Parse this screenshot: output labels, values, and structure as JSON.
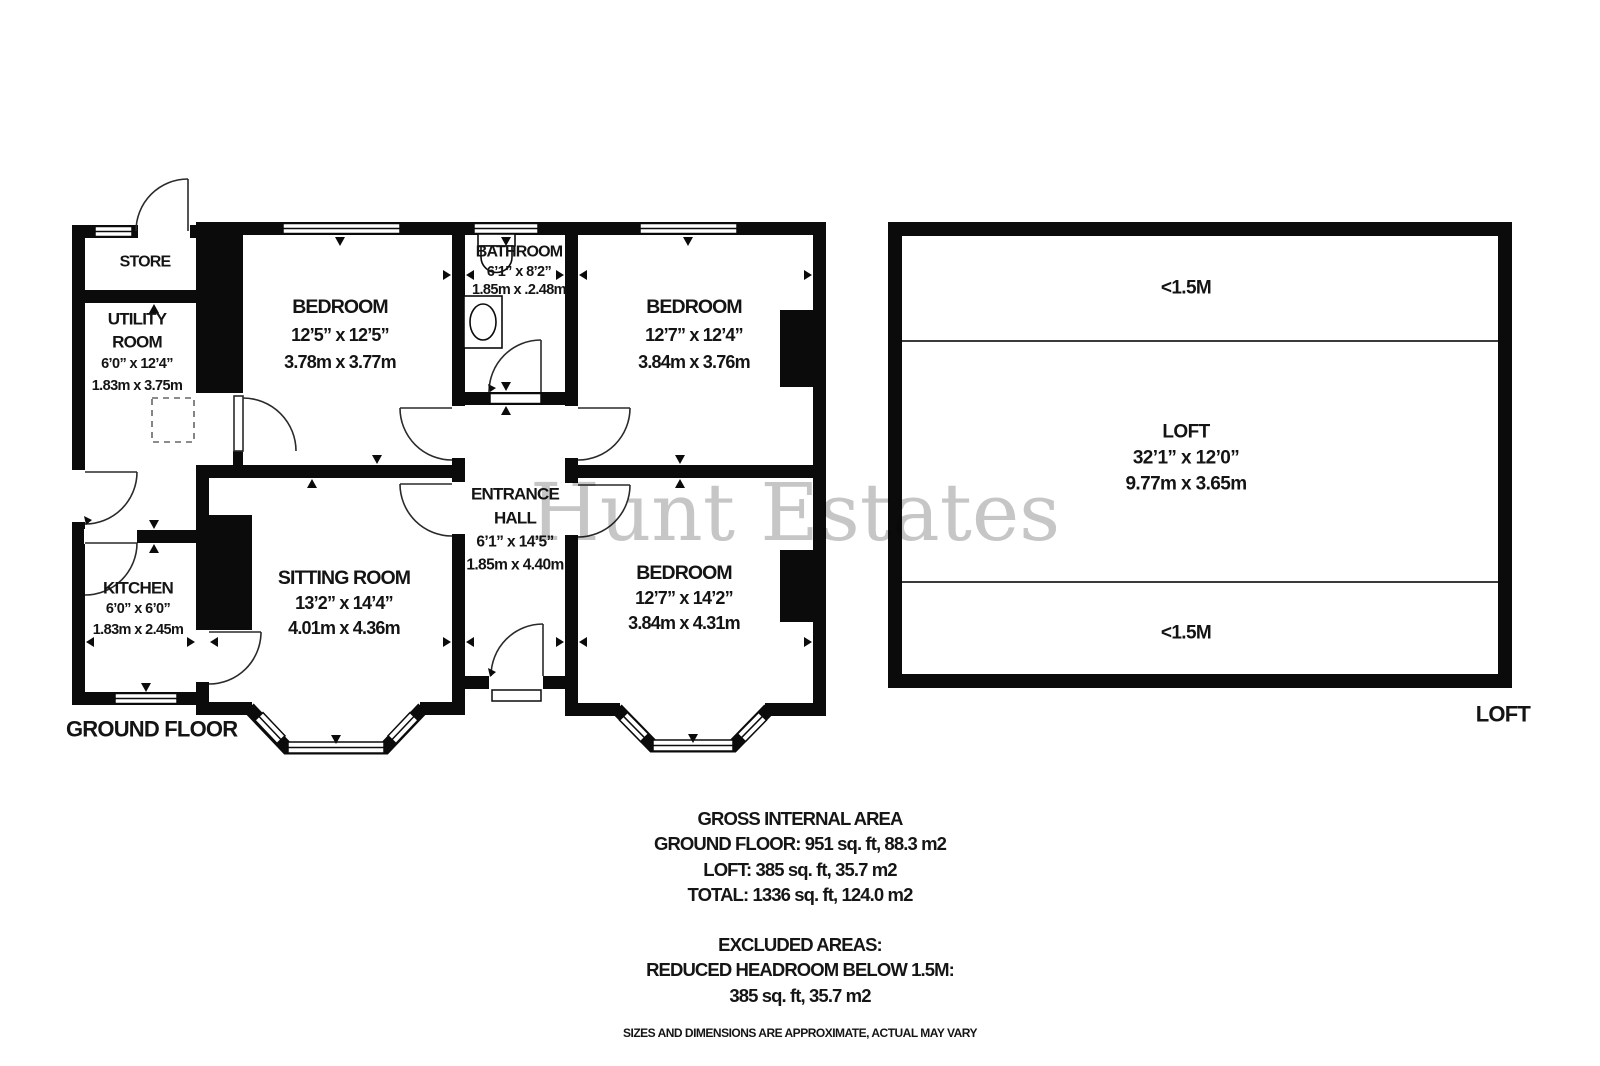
{
  "watermark": "Hunt Estates",
  "plan": {
    "ground_floor": {
      "label": "GROUND FLOOR",
      "rooms": {
        "store": {
          "name": "STORE"
        },
        "utility": {
          "line1": "UTILITY",
          "line2": "ROOM",
          "imperial": "6’0” x 12’4”",
          "metric": "1.83m x 3.75m"
        },
        "bedroom_front_left": {
          "name": "BEDROOM",
          "imperial": "12’5” x 12’5”",
          "metric": "3.78m x 3.77m"
        },
        "bathroom": {
          "name": "BATHROOM",
          "imperial": "6’1” x 8’2”",
          "metric": "1.85m x .2.48m"
        },
        "bedroom_front_right": {
          "name": "BEDROOM",
          "imperial": "12’7” x 12’4”",
          "metric": "3.84m x 3.76m"
        },
        "entrance_hall": {
          "line1": "ENTRANCE",
          "line2": "HALL",
          "imperial": "6’1” x 14’5”",
          "metric": "1.85m x 4.40m"
        },
        "sitting_room": {
          "name": "SITTING ROOM",
          "imperial": "13’2” x 14’4”",
          "metric": "4.01m x 4.36m"
        },
        "bedroom_rear": {
          "name": "BEDROOM",
          "imperial": "12’7” x 14’2”",
          "metric": "3.84m x 4.31m"
        },
        "kitchen": {
          "name": "KITCHEN",
          "imperial": "6’0” x 6’0”",
          "metric": "1.83m x 2.45m"
        }
      }
    },
    "loft_floor": {
      "label": "LOFT",
      "headroom_top": "<1.5M",
      "headroom_bottom": "<1.5M",
      "room": {
        "name": "LOFT",
        "imperial": "32’1” x 12’0”",
        "metric": "9.77m x 3.65m"
      }
    }
  },
  "summary": {
    "gross_title": "GROSS INTERNAL AREA",
    "ground_floor_area": "GROUND FLOOR: 951 sq. ft, 88.3 m2",
    "loft_area": "LOFT: 385 sq. ft, 35.7 m2",
    "total_area": "TOTAL: 1336 sq. ft, 124.0 m2",
    "excluded_title": "EXCLUDED AREAS:",
    "excluded_detail": "REDUCED HEADROOM BELOW 1.5M:",
    "excluded_area": "385 sq. ft, 35.7 m2"
  },
  "disclaimer": "SIZES AND DIMENSIONS ARE APPROXIMATE, ACTUAL MAY VARY",
  "colors": {
    "wall": "#0b0b0b",
    "text": "#141414",
    "watermark": "#c6c6c6"
  }
}
